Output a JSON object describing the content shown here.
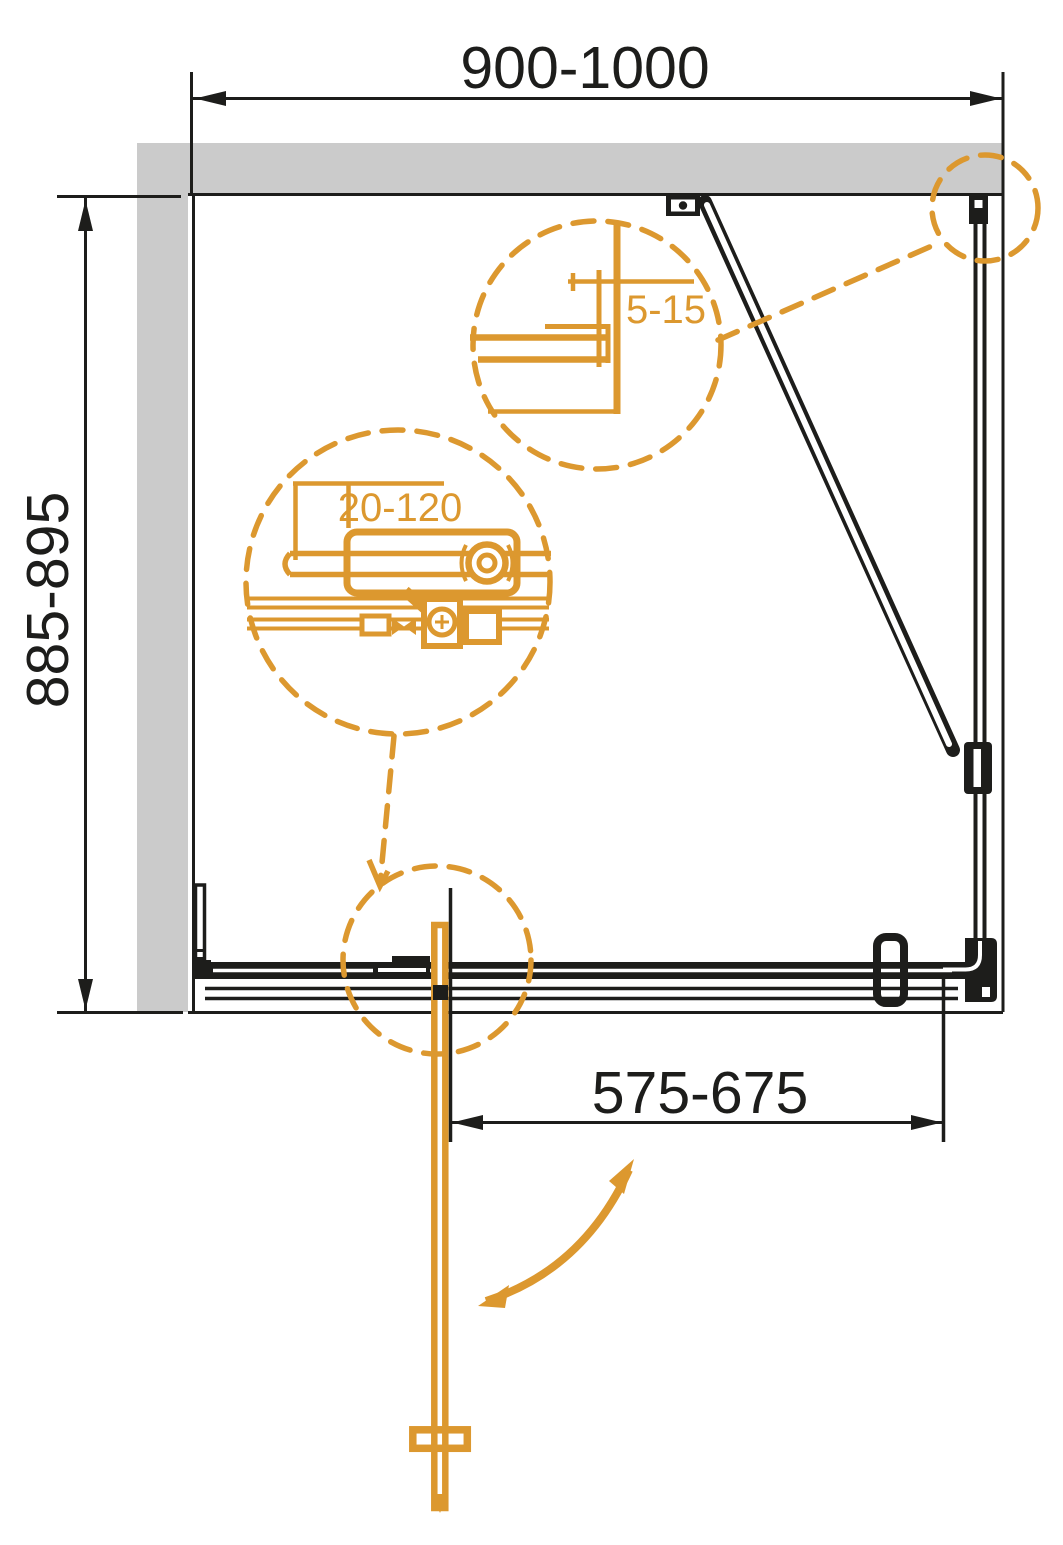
{
  "drawing": {
    "type": "technical-drawing",
    "subject": "shower-enclosure-plan-view-with-detail-callouts",
    "dimensions": {
      "top_width": "900-1000",
      "left_height": "885-895",
      "bottom_door_width": "575-675",
      "detail_wall_profile_adjustment": "5-15",
      "detail_roller_adjustment": "20-120"
    },
    "colors": {
      "accent_orange": "#DC982F",
      "wall_gray": "#CBCBCB",
      "line_black": "#1D1D1B",
      "background": "#FFFFFF"
    }
  }
}
